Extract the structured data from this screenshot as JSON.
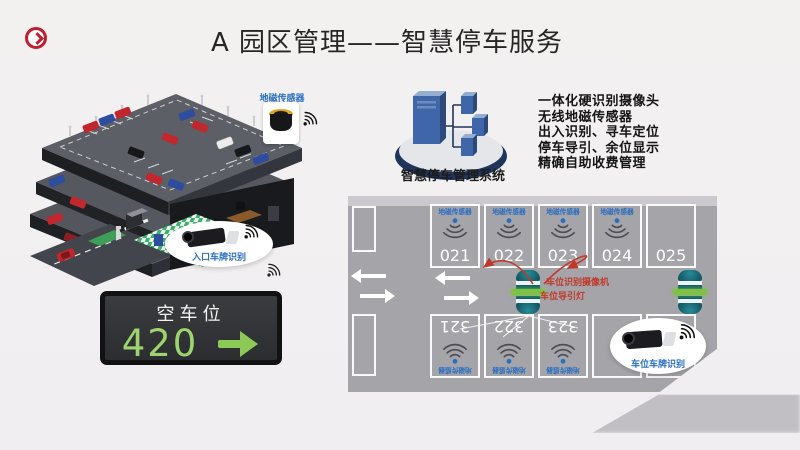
{
  "slide": {
    "title": "A 园区管理——智慧停车服务"
  },
  "garage": {
    "magnetic_sensor_label": "地磁传感器",
    "entrance_camera_label": "入口车牌识别"
  },
  "vacancy_board": {
    "title": "空车位",
    "count": "420"
  },
  "system": {
    "name": "智慧停车管理系统",
    "features": [
      "一体化硬识别摄像头",
      "无线地磁传感器",
      "出入识别、寻车定位",
      "停车导引、余位显示",
      "精确自助收费管理"
    ]
  },
  "parking_map": {
    "magnetic_sensor_label": "地磁传感器",
    "top_space_numbers": [
      "021",
      "022",
      "023",
      "024",
      "025"
    ],
    "bottom_space_numbers": [
      "321",
      "322",
      "323"
    ],
    "camera_label": "车位识别摄像机",
    "guidance_light_label": "车位导引灯",
    "space_plate_camera_label": "车位车牌识别"
  },
  "colors": {
    "accent_red": "#bf1e2e",
    "signal_blue": "#2a6fc2",
    "display_green": "#9ed46d",
    "guide_green": "#7dc243"
  }
}
